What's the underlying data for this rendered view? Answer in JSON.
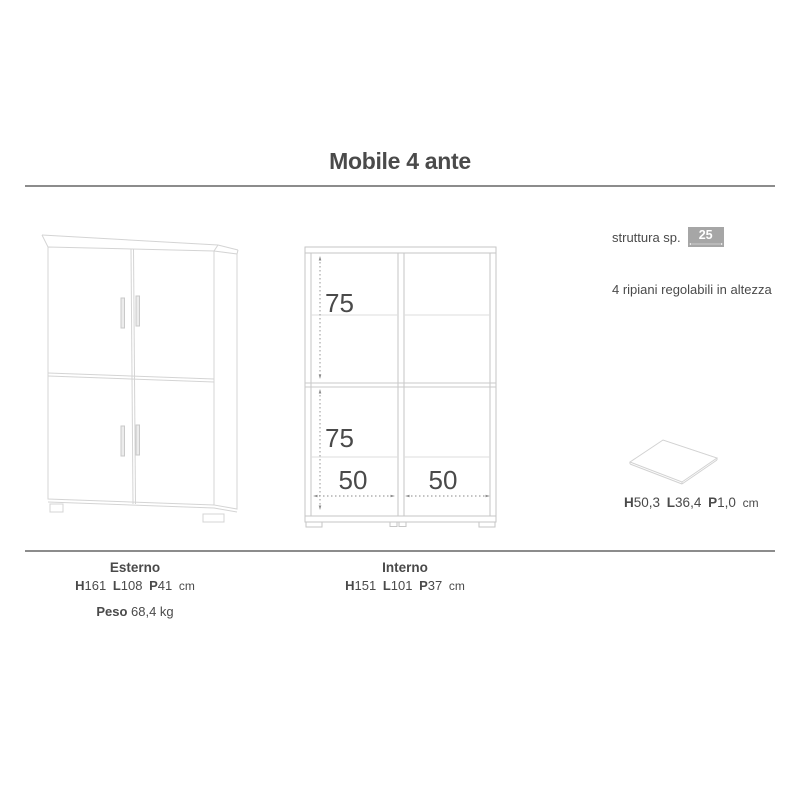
{
  "page": {
    "title": "Mobile 4 ante"
  },
  "colors": {
    "text": "#4a4a4a",
    "rule": "#8c8c8c",
    "badge_bg": "#a6a6a6",
    "badge_text": "#ffffff",
    "cabinet_line": "#d4d4d4",
    "front_view_line": "#c6c6c6",
    "shelf_line": "#dedede",
    "dimension_line": "#8a8a8a"
  },
  "right_panel": {
    "struttura_label": "struttura sp.",
    "struttura_value": "25 mm",
    "ripiani_note": "4 ripiani regolabili in altezza",
    "shelf_dims": {
      "h_label": "H",
      "h_value": "50,3",
      "l_label": "L",
      "l_value": "36,4",
      "p_label": "P",
      "p_value": "1,0",
      "unit": "cm"
    }
  },
  "front_view": {
    "upper_compartment_height": "75",
    "lower_compartment_height": "75",
    "left_compartment_width": "50",
    "right_compartment_width": "50"
  },
  "footer": {
    "esterno": {
      "title": "Esterno",
      "h_label": "H",
      "h_value": "161",
      "l_label": "L",
      "l_value": "108",
      "p_label": "P",
      "p_value": "41",
      "unit": "cm",
      "peso_label": "Peso",
      "peso_value": "68,4 kg"
    },
    "interno": {
      "title": "Interno",
      "h_label": "H",
      "h_value": "151",
      "l_label": "L",
      "l_value": "101",
      "p_label": "P",
      "p_value": "37",
      "unit": "cm"
    }
  }
}
